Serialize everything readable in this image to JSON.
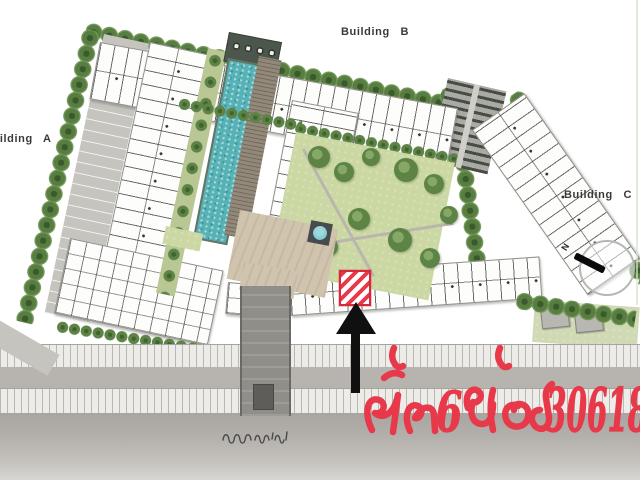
{
  "page": {
    "background": "#ffffff"
  },
  "plan": {
    "buildings": [
      {
        "label": "Building A"
      },
      {
        "label": "Building B"
      },
      {
        "label": "Building C"
      }
    ],
    "road_name": "ถนนราชพฤกษ์",
    "compass": {
      "north_label": "N"
    }
  },
  "annotation": {
    "text": "ชั้น6 ห้อง 30618",
    "floor_number": "6",
    "room_number": "30618",
    "color": "#e8394b"
  },
  "colors": {
    "tree": "#577d41",
    "lawn": "#ccd8a4",
    "pool": "#57b2b6",
    "plaza": "#d0c4ae",
    "road": "#b3b0ab",
    "highlight_red": "#e8394b",
    "arrow_black": "#101010"
  }
}
